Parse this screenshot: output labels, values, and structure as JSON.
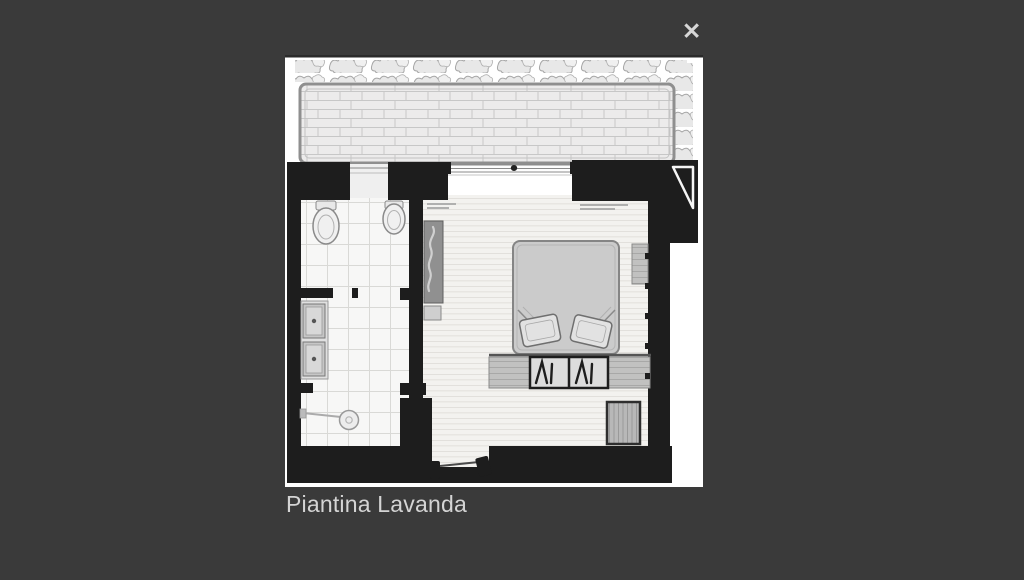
{
  "lightbox": {
    "background_color": "#3a3a3a",
    "close_icon_glyph": "✕",
    "caption": "Piantina Lavanda",
    "palette": {
      "photo_bg": "#ffffff",
      "wall": "#1d1d1d",
      "terrace_floor": "#ecebeb",
      "tile_floor": "#f7f7f6",
      "plank_floor": "#f3f2ef",
      "furniture_gray": "#c9c9c9",
      "text": "#d4d4d4"
    }
  }
}
